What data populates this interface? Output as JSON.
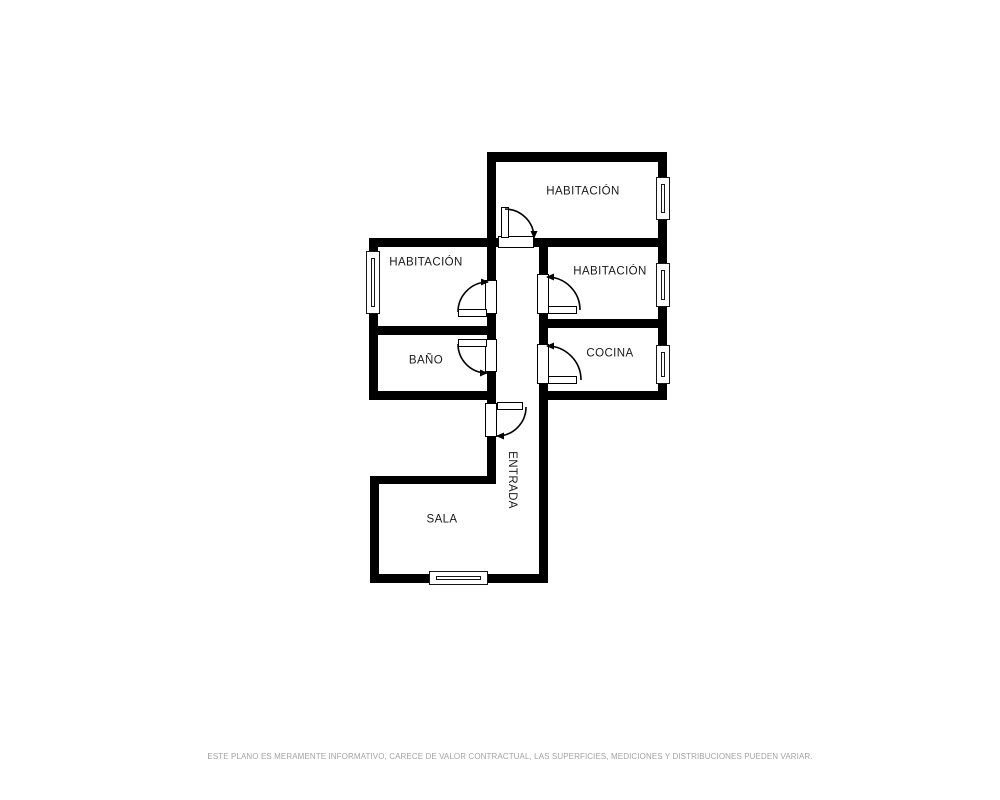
{
  "floor_plan": {
    "rooms": [
      {
        "name": "habitacion-top",
        "label": "HABITACIÓN"
      },
      {
        "name": "habitacion-left",
        "label": "HABITACIÓN"
      },
      {
        "name": "habitacion-right",
        "label": "HABITACIÓN"
      },
      {
        "name": "bano",
        "label": "BAÑO"
      },
      {
        "name": "cocina",
        "label": "COCINA"
      },
      {
        "name": "sala",
        "label": "SALA"
      },
      {
        "name": "entrada",
        "label": "ENTRADA"
      }
    ],
    "colors": {
      "wall": "#000000",
      "door_lines": "#000000",
      "label_text": "#1a1a1a",
      "background": "#ffffff"
    }
  },
  "footer": {
    "disclaimer": "ESTE PLANO ES MERAMENTE INFORMATIVO, CARECE DE VALOR CONTRACTUAL, LAS SUPERFICIES, MEDICIONES Y DISTRIBUCIONES PUEDEN VARIAR.",
    "color": "#a3a3a3"
  }
}
